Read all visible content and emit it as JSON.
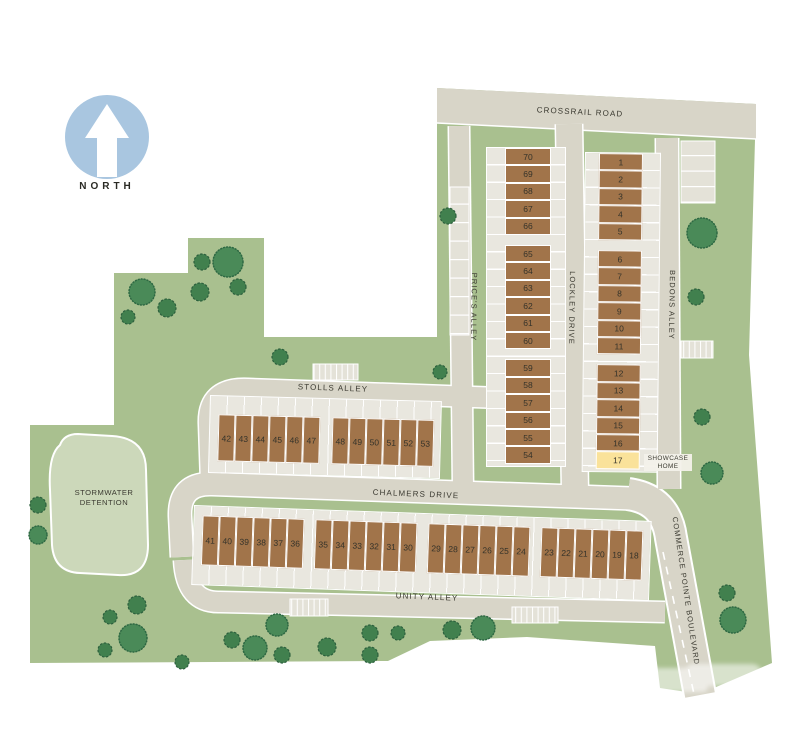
{
  "north_label": "NORTH",
  "road_labels": {
    "crossrail": "CROSSRAIL ROAD",
    "stolls": "STOLLS ALLEY",
    "chalmers": "CHALMERS DRIVE",
    "unity": "UNITY ALLEY",
    "prices": "PRICE'S ALLEY",
    "lockley": "LOCKLEY DRIVE",
    "bedons": "BEDONS ALLEY",
    "commerce": "COMMERCE POINTE BOULEVARD"
  },
  "areas": {
    "stormwater_line1": "STORMWATER",
    "stormwater_line2": "DETENTION"
  },
  "showcase": {
    "lot_number": "17",
    "label_line1": "SHOWCASE",
    "label_line2": "HOME"
  },
  "lots": {
    "prices_col": {
      "g1": [
        "70",
        "69",
        "68",
        "67",
        "66"
      ],
      "g2": [
        "65",
        "64",
        "63",
        "62",
        "61",
        "60"
      ],
      "g3": [
        "59",
        "58",
        "57",
        "56",
        "55",
        "54"
      ]
    },
    "bedons_col": {
      "g1": [
        "1",
        "2",
        "3",
        "4",
        "5"
      ],
      "g2": [
        "6",
        "7",
        "8",
        "9",
        "10",
        "11"
      ],
      "g3": [
        "12",
        "13",
        "14",
        "15",
        "16"
      ]
    },
    "stolls_row": {
      "g1": [
        "42",
        "43",
        "44",
        "45",
        "46",
        "47"
      ],
      "g2": [
        "48",
        "49",
        "50",
        "51",
        "52",
        "53"
      ]
    },
    "unity_row": {
      "g1": [
        "41",
        "40",
        "39",
        "38",
        "37",
        "36"
      ],
      "g2": [
        "35",
        "34",
        "33",
        "32",
        "31",
        "30"
      ],
      "g3": [
        "29",
        "28",
        "27",
        "26",
        "25",
        "24"
      ],
      "g4": [
        "23",
        "22",
        "21",
        "20",
        "19",
        "18"
      ]
    }
  },
  "colors": {
    "site_green": "#a9c08f",
    "road": "#d8d5c8",
    "driveway_strip": "#e9e7df",
    "lot_brown": "#a1744a",
    "showcase_yellow": "#fae29a",
    "pond_green": "#ccd8ba",
    "tree_green": "#41804e",
    "north_blue": "#a9c6e0",
    "label_text": "#3b3a31"
  }
}
